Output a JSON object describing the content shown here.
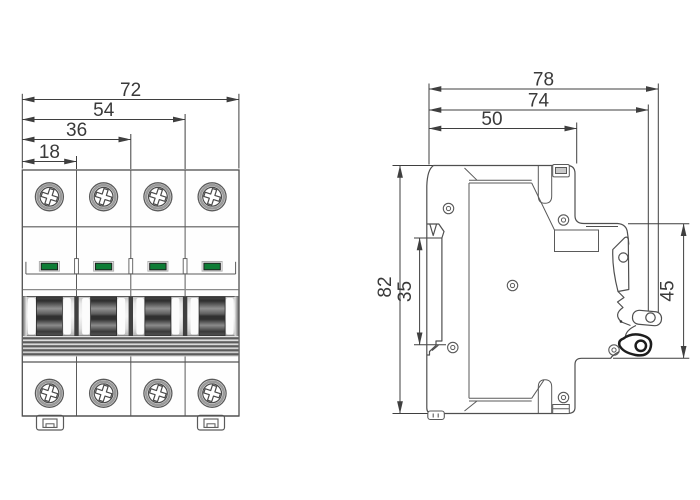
{
  "colors": {
    "outline": "#4f4f4f",
    "dimension": "#3f3f3f",
    "indicator_green": "#0e7d36",
    "handle_dark": "#3a3a3a",
    "background": "#ffffff"
  },
  "front_view": {
    "name": "4-pole circuit breaker front view",
    "pole_count": 4,
    "width_dimensions": [
      {
        "value": "72"
      },
      {
        "value": "54"
      },
      {
        "value": "36"
      },
      {
        "value": "18"
      }
    ]
  },
  "side_view": {
    "name": "circuit breaker side view",
    "depth_dimensions": [
      {
        "value": "78"
      },
      {
        "value": "74"
      },
      {
        "value": "50"
      }
    ],
    "height_dimensions": [
      {
        "value": "82"
      },
      {
        "value": "35"
      },
      {
        "value": "45"
      }
    ]
  }
}
